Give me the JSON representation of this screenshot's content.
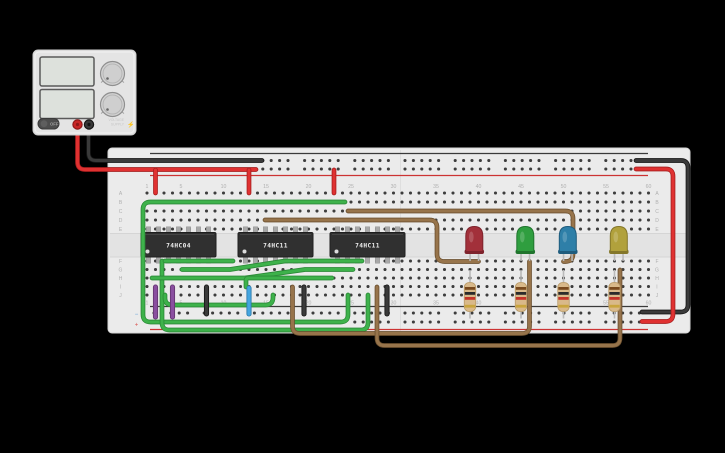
{
  "canvas": {
    "background": "#000000",
    "width": 725,
    "height": 453
  },
  "power_supply": {
    "body_color": "#e4e4e4",
    "display_color": "#dde1dc",
    "off_label": "OFF",
    "brand_line1": "VOLTAGE",
    "brand_line2": "SUPPLY",
    "bolt_glyph": "⚡",
    "terminals": [
      {
        "name": "positive-terminal",
        "color": "#c92626",
        "ring": "#8e1717"
      },
      {
        "name": "negative-terminal",
        "color": "#383838",
        "ring": "#141414"
      }
    ]
  },
  "breadboard": {
    "x": 108,
    "y": 148,
    "w": 582,
    "h": 185,
    "body_color": "#ebebeb",
    "channel_color": "#e3e3e3",
    "row_letters_top": [
      "A",
      "B",
      "C",
      "D",
      "E"
    ],
    "row_letters_bottom": [
      "F",
      "G",
      "H",
      "I",
      "J"
    ],
    "column_numbers": [
      "1",
      "5",
      "10",
      "15",
      "20",
      "25",
      "30",
      "35",
      "40",
      "45",
      "50",
      "55",
      "60"
    ],
    "rail_minus": "−",
    "rail_plus": "+",
    "cols": 60,
    "col_start_x": 147,
    "col_pitch": 8.5,
    "rows_top_y": [
      193,
      202,
      211,
      220,
      229
    ],
    "rows_bottom_y": [
      261,
      269.5,
      278,
      286.5,
      295
    ],
    "rail_rows_top_y": [
      160.5,
      169
    ],
    "rail_rows_bottom_y": [
      313,
      322
    ],
    "numbers_top_y": 188,
    "numbers_bottom_y": 304.5,
    "top_line_black_y": 153.5,
    "top_line_red_y": 175.5,
    "bottom_line_black_y": 306.5,
    "bottom_line_red_y": 329.5,
    "seam_x": 400.5,
    "hole_color": "#3d3d3d",
    "label_color": "#b0b0b0"
  },
  "ics": [
    {
      "label": "74HC04",
      "x": 141,
      "w": 75
    },
    {
      "label": "74HC11",
      "x": 238,
      "w": 75
    },
    {
      "label": "74HC11",
      "x": 330,
      "w": 75
    }
  ],
  "leds": [
    {
      "color_name": "red",
      "body": "#a2303a",
      "edge": "#7e232c",
      "cx": 474.3
    },
    {
      "color_name": "green",
      "body": "#2f9e3f",
      "edge": "#20742d",
      "cx": 525.3
    },
    {
      "color_name": "blue",
      "body": "#2e7fa8",
      "edge": "#1f5c7d",
      "cx": 567.8
    },
    {
      "color_name": "yellow",
      "body": "#b1a13c",
      "edge": "#84772a",
      "cx": 618.8
    }
  ],
  "resistors": [
    {
      "x": 470,
      "bands": [
        "brown",
        "black",
        "red",
        "gold"
      ]
    },
    {
      "x": 521,
      "bands": [
        "brown",
        "black",
        "red",
        "gold"
      ]
    },
    {
      "x": 563.5,
      "bands": [
        "brown",
        "black",
        "red",
        "gold"
      ]
    },
    {
      "x": 614.5,
      "bands": [
        "brown",
        "black",
        "red",
        "gold"
      ]
    }
  ],
  "resistor_style": {
    "body": "#d9b98a",
    "edge": "#b99a66",
    "lead": "#b9b9b9"
  },
  "band_colors": {
    "brown": "#7a4a1e",
    "black": "#2b2b2b",
    "red": "#c4342a",
    "gold": "#c9a53e"
  },
  "wire_colors": {
    "red": {
      "main": "#e03131",
      "edge": "#a81f1f"
    },
    "black": {
      "main": "#3a3a3a",
      "edge": "#161616"
    },
    "green": {
      "main": "#3eb24b",
      "edge": "#2b8a37"
    },
    "brown": {
      "main": "#97744b",
      "edge": "#6d5130"
    },
    "purple": {
      "main": "#8a4fa0",
      "edge": "#63356f"
    },
    "blue": {
      "main": "#45a6e0",
      "edge": "#2d7aa8"
    }
  },
  "wires": [
    {
      "color": "black",
      "path": "M88.5,126 L88.5,153 Q88.5,160.5 96,160.5 L262,160.5"
    },
    {
      "color": "red",
      "path": "M77.5,126 L77.5,162 Q77.5,169.5 85,169.5 L256,169.5"
    },
    {
      "color": "black",
      "path": "M636,160.5 L681,160.5 Q688,160.5 688,168 L688,304.5 Q688,312 680.5,312 L642,312"
    },
    {
      "color": "red",
      "path": "M636,169 L666,169 Q673,169 673,176.5 L673,314 Q673,321.5 665.5,321.5 L642,321.5"
    },
    {
      "color": "red",
      "path": "M155.5,170 L155.5,193"
    },
    {
      "color": "red",
      "path": "M249,170 L249,193"
    },
    {
      "color": "red",
      "path": "M334,170 L334,193"
    },
    {
      "color": "green",
      "path": "M345,202 L150.5,202 Q143,202 143,209.5 L143,314.5 Q143,322 150.5,322 L340.5,322 Q348,322 348,314.5 L348,295"
    },
    {
      "color": "green",
      "path": "M162,261 L162,322.5 Q162,330 169.5,330 L360.5,330 Q368,330 368,322.5 L368,295"
    },
    {
      "color": "green",
      "path": "M165,261 L233,261"
    },
    {
      "color": "green",
      "path": "M182,269.5 L230,269.5 L285,261 L362,261"
    },
    {
      "color": "green",
      "path": "M152,278 L245,278 L305,269.5 L353,269.5"
    },
    {
      "color": "green",
      "path": "M246,287 L246,280.5 Q246,278 248.5,278 L332,278"
    },
    {
      "color": "green",
      "path": "M165,295 L165,298 Q165,305 172.5,305 L265.5,305 Q273,305 273,297.5 L273,295"
    },
    {
      "color": "purple",
      "w": 3.4,
      "path": "M155.5,287 L155.5,317"
    },
    {
      "color": "purple",
      "w": 3.4,
      "path": "M172.5,287 L172.5,317"
    },
    {
      "color": "black",
      "w": 3.4,
      "path": "M206.5,287 L206.5,314"
    },
    {
      "color": "black",
      "w": 3.4,
      "path": "M304,287 L304,314"
    },
    {
      "color": "black",
      "w": 3.4,
      "path": "M387,287 L387,314"
    },
    {
      "color": "blue",
      "w": 3.4,
      "path": "M249,288 L249,314"
    },
    {
      "color": "brown",
      "path": "M265,220 L429.5,220 Q437,220 437,227.5 L437,254 Q437,261.5 444.5,261.5 L478.5,261.5"
    },
    {
      "color": "brown",
      "path": "M348,211 L565.5,211 Q573,211 573,218.5 L573,254 Q573,261.5 565.5,261.5 L563.5,261.5"
    },
    {
      "color": "brown",
      "path": "M292.5,287 L292.5,326 Q292.5,333.5 300,333.5 L522,333.5 Q529.5,333.5 529.5,326 L529.5,261.5"
    },
    {
      "color": "brown",
      "path": "M377,287 L377,338 Q377,345.5 384.5,345.5 L612.5,345.5 Q620,345.5 620,338 L620,270"
    }
  ]
}
